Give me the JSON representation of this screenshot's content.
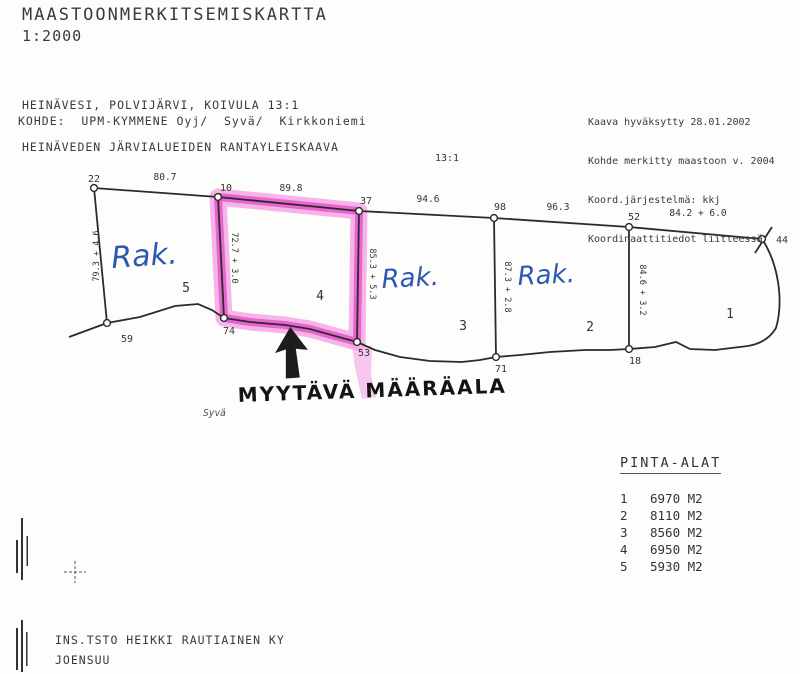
{
  "header": {
    "title": "MAASTOONMERKITSEMISKARTTA",
    "scale": "1:2000",
    "location_line1": "HEINÄVESI, POLVIJÄRVI, KOIVULA 13:1",
    "location_line2": "HEINÄVEDEN JÄRVIALUEIDEN RANTAYLEISKAAVA",
    "kohde_line": "KOHDE:  UPM-KYMMENE Oyj/  Syvä/  Kirkkoniemi"
  },
  "approval_info": {
    "line1": "Kaava hyväksytty 28.01.2002",
    "line2": "Kohde merkitty maastoon v. 2004",
    "line3": "Koord.järjestelmä: kkj",
    "line4": "Koordinaattitiedot liitteessä"
  },
  "map": {
    "property_id": "13:1",
    "points": {
      "p22": "22",
      "p10": "10",
      "p37": "37",
      "p98": "98",
      "p52": "52",
      "p44": "44",
      "p59": "59",
      "p74": "74",
      "p53": "53",
      "p71": "71",
      "p18": "18"
    },
    "edges": {
      "e22_10": "80.7",
      "e10_37": "89.8",
      "e37_98": "94.6",
      "e98_52": "96.3",
      "e52_44": "84.2 + 6.0",
      "e22_59": "79.3 + 4.6",
      "e10_74": "72.7 + 3.0",
      "e37_53": "85.3 + 5.3",
      "e98_71": "87.3 + 2.8",
      "e52_18": "84.6 + 3.2"
    },
    "parcels": {
      "n1": "1",
      "n2": "2",
      "n3": "3",
      "n4": "4",
      "n5": "5"
    },
    "annotations": {
      "rak5": "Rak.",
      "rak3": "Rak.",
      "rak2": "Rak.",
      "myytava": "MYYTÄVÄ MÄÄRÄALA",
      "syva": "Syvä"
    },
    "colors": {
      "highlight": "#e649c6",
      "highlight_halo": "#f4a3e3",
      "ink": "#2b2b2b",
      "handwriting_blue": "#2d57b5"
    }
  },
  "areas_table": {
    "title": "PINTA-ALAT",
    "rows": [
      {
        "num": "1",
        "area": "6970 M2"
      },
      {
        "num": "2",
        "area": "8110 M2"
      },
      {
        "num": "3",
        "area": "8560 M2"
      },
      {
        "num": "4",
        "area": "6950 M2"
      },
      {
        "num": "5",
        "area": "5930 M2"
      }
    ]
  },
  "footer": {
    "company": "INS.TSTO HEIKKI RAUTIAINEN KY",
    "city": "JOENSUU"
  }
}
